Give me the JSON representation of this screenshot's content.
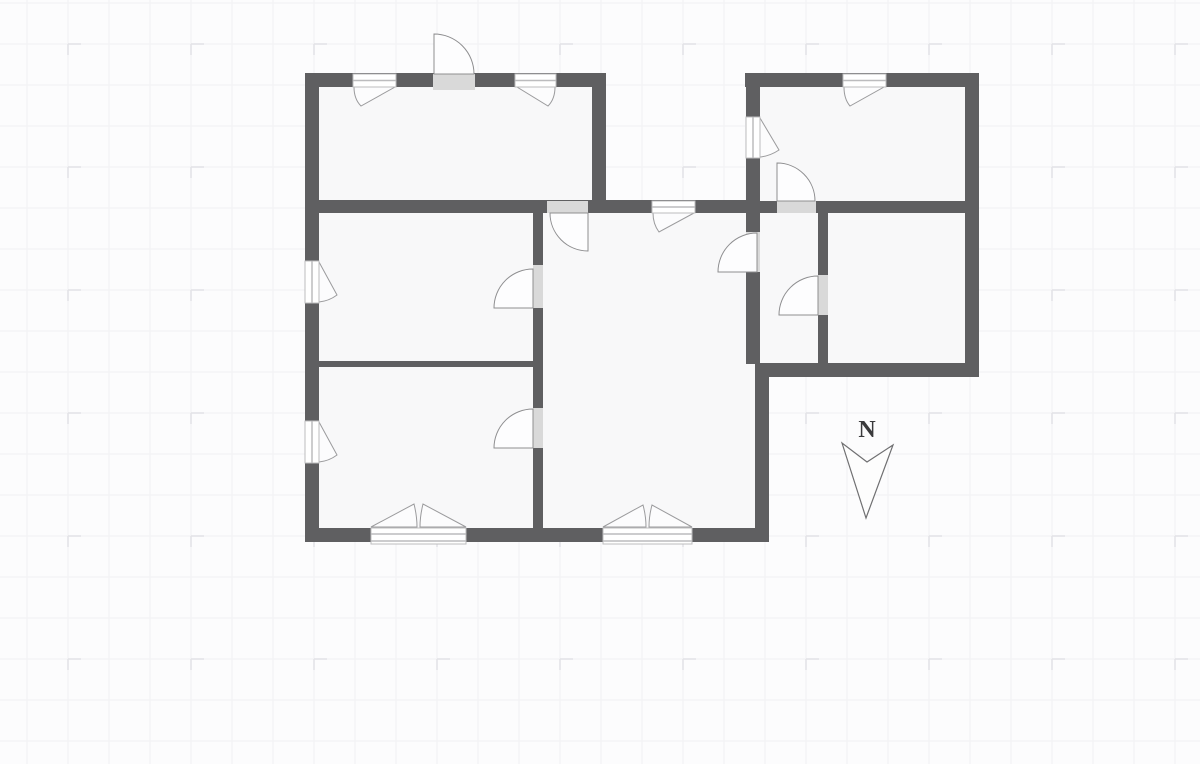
{
  "canvas": {
    "width": 1200,
    "height": 764
  },
  "colors": {
    "background": "#fcfcfd",
    "grid_minor_line": "#f1f1f4",
    "grid_tick": "#e2e2e6",
    "room_fill": "#f8f8f9",
    "wall": "#5f5f61",
    "door_gap_fill": "#d9d9d9",
    "door_swing_fill": "#fdfdfe",
    "door_swing_stroke": "#8e8e90",
    "window_fill": "#ffffff",
    "window_frame": "#bcbcbe",
    "sash_fill": "#fcfcfd",
    "sash_stroke": "#9b9b9d",
    "north_stroke": "#6f6f71",
    "north_fill": "#fdfdfd"
  },
  "grid": {
    "minor_step": 41,
    "minor_offset_x": 27,
    "minor_offset_y": 3,
    "tick_step": 123,
    "tick_offset_x": 68,
    "tick_offset_y": 44,
    "tick_len_h": 13,
    "tick_len_v": 11
  },
  "north_arrow": {
    "label": "N",
    "label_x": 867,
    "label_y": 417,
    "dart_path": "M842,443 L866,518 L893,445 L867,462 Z"
  },
  "floor_plan": {
    "rooms": [
      {
        "id": "room-top-left",
        "rect": [
          305,
          73,
          301,
          140
        ]
      },
      {
        "id": "room-middle-left",
        "rect": [
          305,
          200,
          238,
          167
        ]
      },
      {
        "id": "room-bottom-left",
        "rect": [
          305,
          361,
          238,
          181
        ]
      },
      {
        "id": "room-living-middle",
        "rect": [
          533,
          200,
          236,
          342
        ]
      },
      {
        "id": "room-top-right",
        "rect": [
          745,
          73,
          234,
          140
        ]
      },
      {
        "id": "room-small-right",
        "rect": [
          746,
          200,
          82,
          177
        ]
      },
      {
        "id": "room-big-right",
        "rect": [
          818,
          200,
          161,
          177
        ]
      }
    ],
    "walls": [
      {
        "id": "wall-top-left-exterior",
        "rect": [
          305,
          73,
          301,
          14
        ]
      },
      {
        "id": "wall-top-right-exterior",
        "rect": [
          745,
          73,
          234,
          14
        ]
      },
      {
        "id": "wall-middle-band",
        "rect": [
          305,
          200,
          455,
          13
        ]
      },
      {
        "id": "wall-right-wing-divider",
        "rect": [
          746,
          201,
          219,
          12
        ]
      },
      {
        "id": "wall-left-thin-partition",
        "rect": [
          318,
          361,
          218,
          6
        ]
      },
      {
        "id": "wall-bottom-exterior",
        "rect": [
          305,
          528,
          464,
          14
        ]
      },
      {
        "id": "wall-right-wing-bottom",
        "rect": [
          755,
          363,
          224,
          14
        ]
      },
      {
        "id": "wall-left-exterior",
        "rect": [
          305,
          73,
          14,
          469
        ]
      },
      {
        "id": "wall-topleft-room-right",
        "rect": [
          592,
          73,
          14,
          140
        ]
      },
      {
        "id": "wall-interior-vertical-left",
        "rect": [
          533,
          200,
          10,
          335
        ]
      },
      {
        "id": "wall-right-wing-left",
        "rect": [
          746,
          73,
          14,
          291
        ]
      },
      {
        "id": "wall-living-right",
        "rect": [
          755,
          363,
          14,
          179
        ]
      },
      {
        "id": "wall-right-wing-right",
        "rect": [
          965,
          73,
          14,
          304
        ]
      },
      {
        "id": "wall-right-wing-interior",
        "rect": [
          818,
          213,
          10,
          151
        ]
      }
    ],
    "doors": [
      {
        "id": "door-entrance-top",
        "gap": [
          433,
          74,
          42,
          16
        ],
        "swing": "M434,74 L434,34 A40,40 0 0 1 474,74 Z"
      },
      {
        "id": "door-topleft-to-living",
        "gap": [
          547,
          201,
          41,
          12
        ],
        "swing": "M588,213 L588,251 A38,38 0 0 1 550,213 Z"
      },
      {
        "id": "door-living-to-midleft",
        "gap": [
          533,
          265,
          10,
          43
        ],
        "swing": "M533,308 L494,308 A39,39 0 0 1 533,269 Z"
      },
      {
        "id": "door-living-to-bottomleft",
        "gap": [
          533,
          408,
          10,
          40
        ],
        "swing": "M533,448 L494,448 A39,39 0 0 1 533,409 Z"
      },
      {
        "id": "door-topright-room",
        "gap": [
          777,
          201,
          39,
          12
        ],
        "swing": "M777,201 L777,163 A38,38 0 0 1 815,201 Z"
      },
      {
        "id": "door-living-to-smallright",
        "gap": [
          746,
          232,
          14,
          40
        ],
        "swing": "M757,272 L718,272 A39,39 0 0 1 757,233 Z"
      },
      {
        "id": "door-smallright-to-bigright",
        "gap": [
          818,
          275,
          10,
          40
        ],
        "swing": "M818,315 L779,315 A39,39 0 0 1 818,276 Z"
      }
    ],
    "windows": [
      {
        "id": "window-topleft-1",
        "rect": [
          353,
          74,
          43,
          13
        ],
        "lines": [
          [
            353,
            80.5,
            396,
            80.5
          ]
        ],
        "sash": "M354,87 Q354,99 361,106 L395,87 Z"
      },
      {
        "id": "window-topleft-2",
        "rect": [
          515,
          74,
          41,
          13
        ],
        "lines": [
          [
            515,
            80.5,
            556,
            80.5
          ]
        ],
        "sash": "M555,87 Q555,99 548,106 L517,87 Z"
      },
      {
        "id": "window-mid-band",
        "rect": [
          652,
          201,
          43,
          12
        ],
        "lines": [
          [
            652,
            207,
            695,
            207
          ]
        ],
        "sash": "M653,213 Q653,224 659,232 L694,213 Z"
      },
      {
        "id": "window-topright",
        "rect": [
          843,
          74,
          43,
          13
        ],
        "lines": [
          [
            843,
            80.5,
            886,
            80.5
          ]
        ],
        "sash": "M844,87 Q844,99 850,106 L884,87 Z"
      },
      {
        "id": "window-rightwing-left",
        "rect": [
          746,
          117,
          14,
          41
        ],
        "lines": [
          [
            753,
            117,
            753,
            158
          ]
        ],
        "sash": "M760,157 Q770,156 779,150 L760,118 Z"
      },
      {
        "id": "window-left-upper",
        "rect": [
          305,
          261,
          14,
          42
        ],
        "lines": [
          [
            312,
            261,
            312,
            303
          ]
        ],
        "sash": "M319,302 Q329,301 337,295 L319,262 Z"
      },
      {
        "id": "window-left-lower",
        "rect": [
          305,
          421,
          14,
          42
        ],
        "lines": [
          [
            312,
            421,
            312,
            463
          ]
        ],
        "sash": "M319,462 Q329,461 337,455 L319,422 Z"
      },
      {
        "id": "window-bottom-double-left",
        "rect": [
          371,
          528,
          95,
          16
        ],
        "lines": [
          [
            371,
            534,
            466,
            534
          ],
          [
            371,
            541,
            466,
            541
          ]
        ],
        "sash": "M371,527 L414,504 Q417,516 417,527 Z M466,527 L423,504 Q420,516 420,527 Z"
      },
      {
        "id": "window-bottom-double-right",
        "rect": [
          603,
          528,
          89,
          16
        ],
        "lines": [
          [
            603,
            534,
            692,
            534
          ],
          [
            603,
            541,
            692,
            541
          ]
        ],
        "sash": "M603,527 L643,505 Q646,516 646,527 Z M692,527 L652,505 Q649,516 649,527 Z"
      }
    ]
  }
}
